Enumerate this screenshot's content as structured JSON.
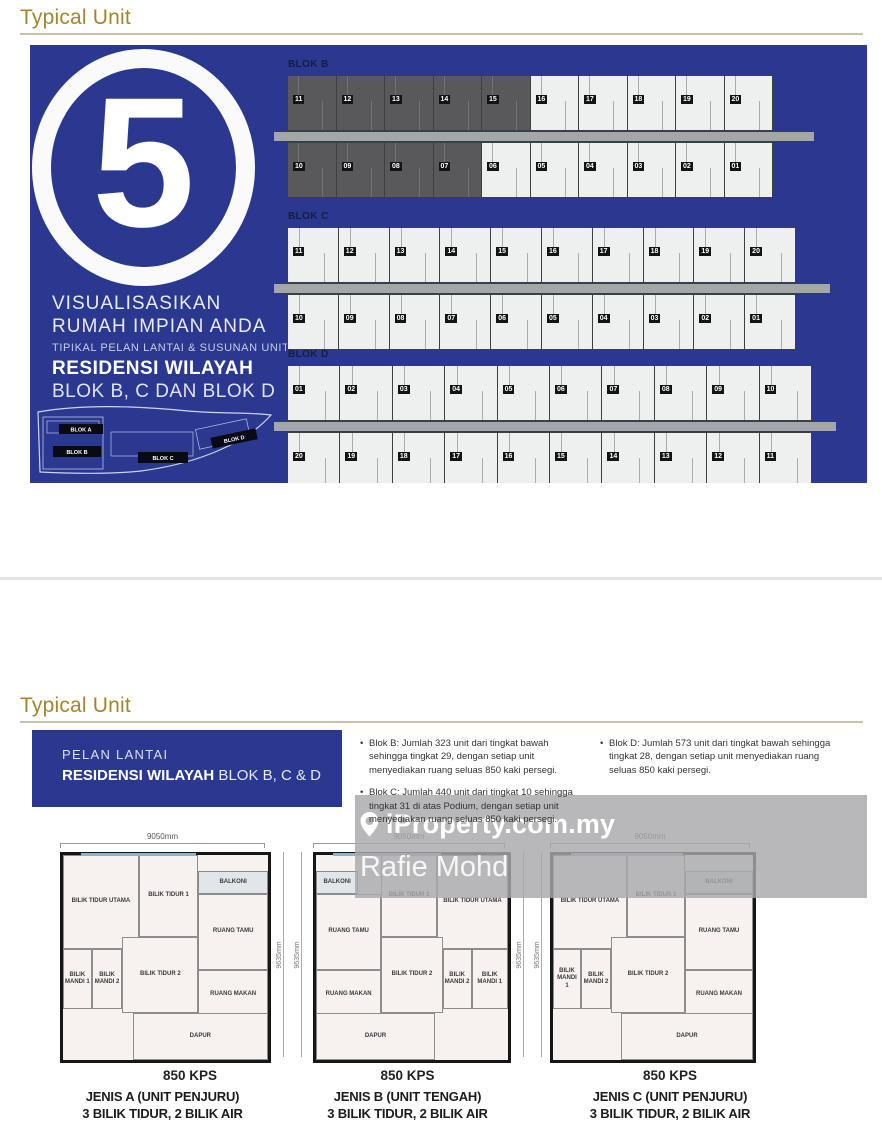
{
  "colors": {
    "panel_blue": "#2b3890",
    "heading_gold": "#a1862f",
    "unit_dark": "#59595b",
    "corridor_gray": "#a4a6a9",
    "watermark_gray": "#a8a8ab"
  },
  "section1": {
    "title": "Typical Unit"
  },
  "section2": {
    "title": "Typical Unit"
  },
  "poster": {
    "number": "5",
    "headline_line1": "VISUALISASIKAN",
    "headline_line2": "RUMAH IMPIAN ANDA",
    "subline": "TIPIKAL PELAN LANTAI & SUSUNAN UNIT",
    "project_bold": "RESIDENSI WILAYAH",
    "project_rest": "BLOK B, C DAN BLOK D",
    "siteplan_labels": [
      "BLOK A",
      "BLOK B",
      "BLOK C",
      "BLOK D"
    ],
    "blocks": [
      {
        "name": "BLOK B",
        "top": [
          "11",
          "12",
          "13",
          "14",
          "15",
          "16",
          "17",
          "18",
          "19",
          "20"
        ],
        "top_dark": [
          "11",
          "12",
          "13",
          "14",
          "15"
        ],
        "bottom": [
          "10",
          "09",
          "08",
          "07",
          "06",
          "05",
          "04",
          "03",
          "02",
          "01"
        ],
        "bottom_dark": [
          "10",
          "09",
          "08",
          "07"
        ]
      },
      {
        "name": "BLOK C",
        "top": [
          "11",
          "12",
          "13",
          "14",
          "15",
          "16",
          "17",
          "18",
          "19",
          "20"
        ],
        "top_dark": [],
        "bottom": [
          "10",
          "09",
          "08",
          "07",
          "06",
          "05",
          "04",
          "03",
          "02",
          "01"
        ],
        "bottom_dark": []
      },
      {
        "name": "BLOK D",
        "top": [
          "01",
          "02",
          "03",
          "04",
          "05",
          "06",
          "07",
          "08",
          "09",
          "10"
        ],
        "top_dark": [],
        "bottom": [
          "20",
          "19",
          "18",
          "17",
          "16",
          "15",
          "14",
          "13",
          "12",
          "11"
        ],
        "bottom_dark": []
      }
    ]
  },
  "info": {
    "box_line1": "PELAN LANTAI",
    "box_title_bold": "RESIDENSI WILAYAH",
    "box_title_rest": " BLOK B, C & D",
    "bullets_col1": [
      "Blok B: Jumlah 323 unit dari tingkat bawah sehingga tingkat 29, dengan setiap unit menyediakan ruang seluas 850 kaki persegi.",
      "Blok C: Jumlah 440 unit dari tingkat 10 sehingga tingkat 31 di atas Podium, dengan setiap unit menyediakan ruang seluas 850 kaki persegi."
    ],
    "bullets_col2": [
      "Blok D: Jumlah 573 unit dari tingkat bawah sehingga tingkat 28, dengan setiap unit menyediakan ruang seluas 850 kaki persegi."
    ]
  },
  "watermark": {
    "logo": "iProperty.com.my",
    "user": "Rafie Mohd"
  },
  "floorplans": {
    "width_label": "9050mm",
    "height_labels": [
      "9635mm",
      "9635mm"
    ],
    "area_label": "850 KPS",
    "plans": [
      {
        "name": "JENIS A (UNIT PENJURU)",
        "spec": "3 BILIK TIDUR, 2 BILIK AIR",
        "rooms": [
          {
            "l": "BILIK TIDUR UTAMA",
            "x": 0,
            "y": 0,
            "w": 37,
            "h": 46
          },
          {
            "l": "BILIK TIDUR 1",
            "x": 37,
            "y": 0,
            "w": 29,
            "h": 40
          },
          {
            "l": "BALKONI",
            "x": 66,
            "y": 8,
            "w": 34,
            "h": 11,
            "c": "balkoni"
          },
          {
            "l": "RUANG TAMU",
            "x": 66,
            "y": 19,
            "w": 34,
            "h": 37
          },
          {
            "l": "BILIK MANDI 1",
            "x": 0,
            "y": 46,
            "w": 14,
            "h": 29
          },
          {
            "l": "BILIK MANDI 2",
            "x": 14,
            "y": 46,
            "w": 15,
            "h": 29
          },
          {
            "l": "BILIK TIDUR 2",
            "x": 29,
            "y": 40,
            "w": 37,
            "h": 37
          },
          {
            "l": "RUANG MAKAN",
            "x": 66,
            "y": 56,
            "w": 34,
            "h": 24
          },
          {
            "l": "DAPUR",
            "x": 34,
            "y": 77,
            "w": 66,
            "h": 23
          }
        ]
      },
      {
        "name": "JENIS B (UNIT TENGAH)",
        "spec": "3 BILIK TIDUR, 2 BILIK AIR",
        "rooms": [
          {
            "l": "BALKONI",
            "x": 0,
            "y": 8,
            "w": 22,
            "h": 11,
            "c": "balkoni"
          },
          {
            "l": "RUANG TAMU",
            "x": 0,
            "y": 19,
            "w": 34,
            "h": 37
          },
          {
            "l": "BILIK TIDUR 1",
            "x": 34,
            "y": 0,
            "w": 29,
            "h": 40
          },
          {
            "l": "BILIK TIDUR UTAMA",
            "x": 63,
            "y": 0,
            "w": 37,
            "h": 46
          },
          {
            "l": "RUANG MAKAN",
            "x": 0,
            "y": 56,
            "w": 34,
            "h": 24
          },
          {
            "l": "BILIK TIDUR 2",
            "x": 34,
            "y": 40,
            "w": 32,
            "h": 37
          },
          {
            "l": "BILIK MANDI 2",
            "x": 66,
            "y": 46,
            "w": 15,
            "h": 29
          },
          {
            "l": "BILIK MANDI 1",
            "x": 81,
            "y": 46,
            "w": 19,
            "h": 29
          },
          {
            "l": "DAPUR",
            "x": 0,
            "y": 77,
            "w": 62,
            "h": 23
          }
        ]
      },
      {
        "name": "JENIS C (UNIT PENJURU)",
        "spec": "3 BILIK TIDUR, 2 BILIK AIR",
        "rooms": [
          {
            "l": "BILIK TIDUR UTAMA",
            "x": 0,
            "y": 0,
            "w": 37,
            "h": 46
          },
          {
            "l": "BILIK TIDUR 1",
            "x": 37,
            "y": 0,
            "w": 29,
            "h": 40
          },
          {
            "l": "BALKONI",
            "x": 66,
            "y": 8,
            "w": 34,
            "h": 11,
            "c": "balkoni"
          },
          {
            "l": "RUANG TAMU",
            "x": 66,
            "y": 19,
            "w": 34,
            "h": 37
          },
          {
            "l": "BILIK MANDI 1",
            "x": 0,
            "y": 46,
            "w": 14,
            "h": 29
          },
          {
            "l": "BILIK MANDI 2",
            "x": 14,
            "y": 46,
            "w": 15,
            "h": 29
          },
          {
            "l": "BILIK TIDUR 2",
            "x": 29,
            "y": 40,
            "w": 37,
            "h": 37
          },
          {
            "l": "RUANG MAKAN",
            "x": 66,
            "y": 56,
            "w": 34,
            "h": 24
          },
          {
            "l": "DAPUR",
            "x": 34,
            "y": 77,
            "w": 66,
            "h": 23
          }
        ]
      }
    ]
  }
}
